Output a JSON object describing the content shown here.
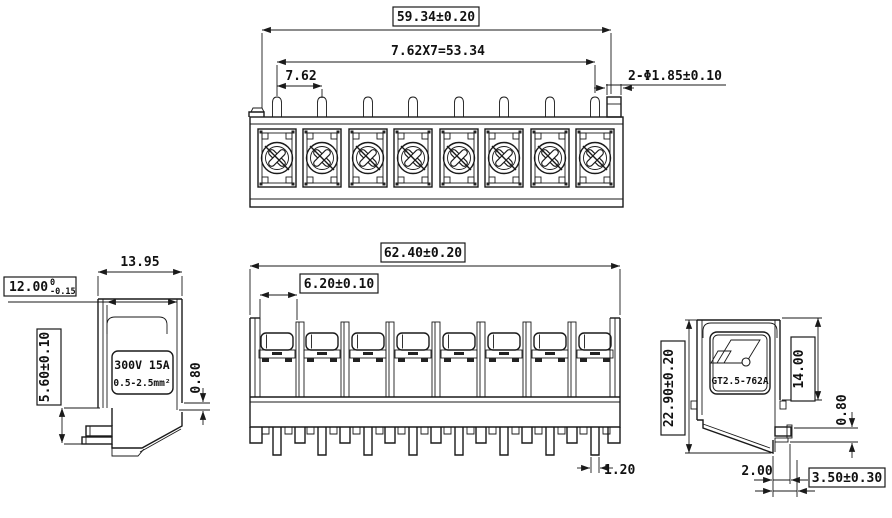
{
  "drawing": {
    "views": {
      "top": {
        "dim_total": "59.34±0.20",
        "dim_pitch_total": "7.62X7=53.34",
        "dim_pitch": "7.62",
        "dim_holes": "2-Φ1.85±0.10"
      },
      "left": {
        "dim_width": "13.95",
        "dim_inner_width": "12.00",
        "dim_inner_width_tol_up": "0",
        "dim_inner_width_tol_dn": "-0.15",
        "dim_pin_height": "5.60±0.10",
        "dim_step": "0.80",
        "label_rating": "300V 15A",
        "label_wire": "0.5-2.5mm²"
      },
      "front": {
        "dim_total": "62.40±0.20",
        "dim_opening": "6.20±0.10",
        "dim_pin_width": "1.20"
      },
      "right": {
        "dim_height": "22.90±0.20",
        "dim_upper_height": "14.00",
        "dim_pin_thickness": "0.80",
        "dim_pin_length": "2.00",
        "dim_pin_offset": "3.50±0.30",
        "label_model": "GT2.5-762A"
      }
    }
  }
}
